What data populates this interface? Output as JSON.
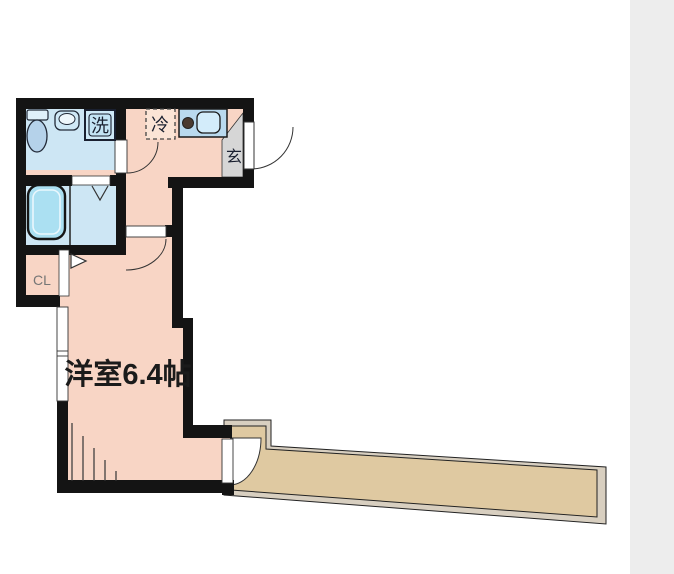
{
  "canvas": {
    "width": 674,
    "height": 574,
    "background": "#ffffff",
    "right_strip_color": "#ededed"
  },
  "floor_plan": {
    "rooms": {
      "main_room": {
        "label": "洋室6.4帖"
      },
      "closet": {
        "label": "CL"
      },
      "entrance": {
        "label": "玄"
      },
      "washer_space": {
        "label": "洗"
      },
      "refrigerator_space": {
        "label": "冷"
      }
    },
    "colors": {
      "wall": "#141414",
      "floor_pink": "#f8d5c5",
      "fridge_fill": "#fbe4d6",
      "wet_room_blue": "#cde6f4",
      "tub_fill": "#abe0f2",
      "counter_blue": "#b9d9ee",
      "sink_fill": "#d3ecfa",
      "basin_fill": "#cfe8f6",
      "basin_bowl": "#eef7fc",
      "toilet_fill": "#b5d2ea",
      "toilet_tank": "#dff0fa",
      "washer_fill": "#cfe9f7",
      "washer_inner": "#c4e4f5",
      "burner_fill": "#4a3a30",
      "entrance_gray": "#d6d6d6",
      "balcony_fill": "#dfc9a1",
      "balcony_rim": "#d8cfc0",
      "label_dark": "#1a2030",
      "label_gray": "#767676",
      "room_label_color": "#1b1b1b"
    }
  }
}
